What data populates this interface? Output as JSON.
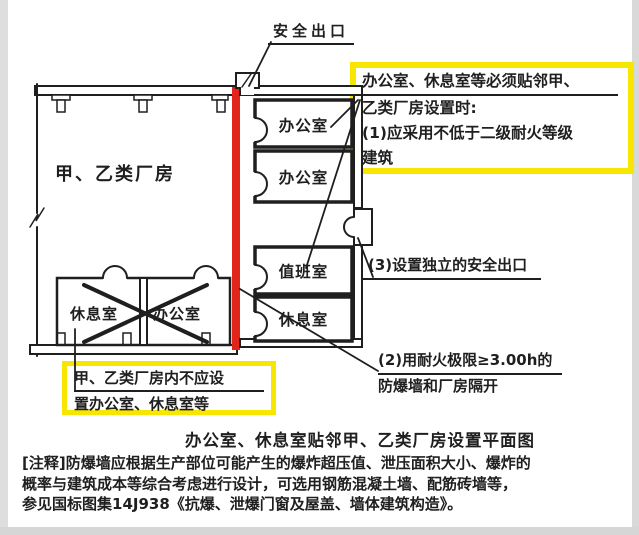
{
  "colors": {
    "highlight_yellow": "#f7e600",
    "blast_wall_red": "#e1251b",
    "line_black": "#1f1f1f"
  },
  "plan": {
    "safety_exit_label": "安全出口",
    "factory_label": "甲、乙类厂房",
    "right_rooms": [
      {
        "label": "办公室"
      },
      {
        "label": "办公室"
      },
      {
        "label": "值班室"
      },
      {
        "label": "休息室"
      }
    ],
    "crossed_rooms": [
      {
        "label": "休息室"
      },
      {
        "label": "办公室"
      }
    ]
  },
  "callouts": {
    "adjacency_box": {
      "line1": "办公室、休息室等必须贴邻甲、",
      "line2": "乙类厂房设置时:",
      "line3": "(1)应采用不低于二级耐火等级",
      "line4": "建筑"
    },
    "independent_exit_label": "(3)设置独立的安全出口",
    "firewall_label": {
      "line1": "(2)用耐火极限≥3.00h的",
      "line2": "防爆墙和厂房隔开"
    },
    "prohibition_box": {
      "line1": "甲、乙类厂房内不应设",
      "line2": "置办公室、休息室等"
    }
  },
  "caption": "办公室、休息室贴邻甲、乙类厂房设置平面图",
  "notes": {
    "line1": "[注释]防爆墙应根据生产部位可能产生的爆炸超压值、泄压面积大小、爆炸的",
    "line2": "概率与建筑成本等综合考虑进行设计，可选用钢筋混凝土墙、配筋砖墙等，",
    "line3": "参见国标图集14J938《抗爆、泄爆门窗及屋盖、墙体建筑构造》。"
  }
}
